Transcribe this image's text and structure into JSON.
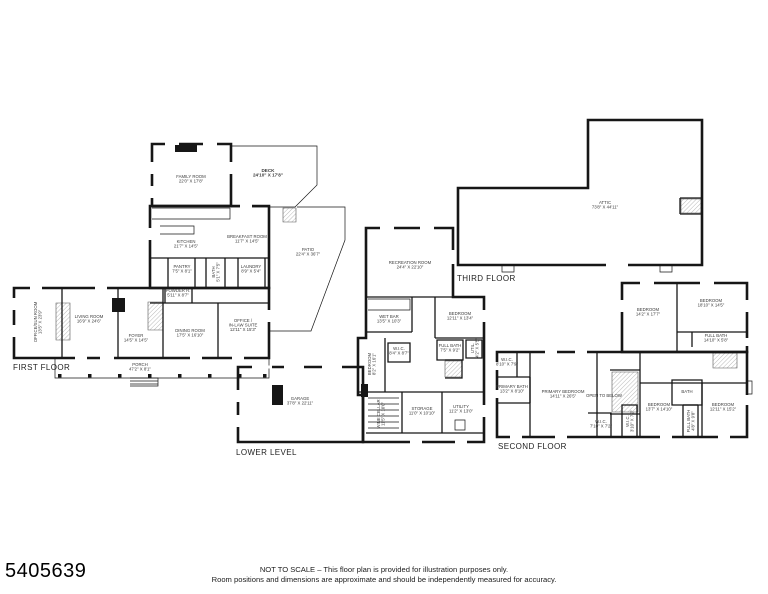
{
  "page": {
    "listing_id": "5405639",
    "disclaimer1": "NOT TO SCALE – This floor plan is provided for illustration purposes only.",
    "disclaimer2": "Room positions and dimensions are approximate and should be independently measured for accuracy."
  },
  "plan": {
    "ink": "#161616",
    "label_color": "#222222",
    "room_color": "#3a3a3a",
    "floors": [
      {
        "id": "first-floor",
        "label": "FIRST FLOOR",
        "label_x": 13,
        "label_y": 370,
        "walls": [
          "M152,144 H231 V206 H152 Z",
          "M150,206 H269 V288 H150 Z",
          "M14,288 H269 V358 H14 Z"
        ],
        "mid": [
          "M62,288 V358",
          "M118,288 V358",
          "M163,288 V358",
          "M150,258 H269",
          "M168,258 V288",
          "M195,258 V288",
          "M206,258 V288",
          "M225,258 V288",
          "M238,258 V288",
          "M265,258 V288",
          "M150,303 H269",
          "M165,288 V303",
          "M192,288 V303",
          "M218,303 V358"
        ],
        "thin": [
          "M231,146 H317 V185 L295,207 H231",
          "M297,207 H345 V240 L311,331 H269",
          "M55,358 V378 H269 V358",
          "M130,378 H158 V386 H130",
          "M130,381 H158",
          "M130,384 H158",
          "M152,208 H230 V219 H152",
          "M160,226 H194 V234 H160"
        ],
        "hatch": [
          "M56,303 h14 v37 h-14 Z",
          "M148,302 h15 v28 h-15 Z",
          "M283,208 h13 v14 h-13 Z"
        ],
        "solid": [
          "M175,145 h22 v7 h-22 Z",
          "M112,298 h13 v14 h-13 Z",
          "M58,374 h3.5 v3.5 h-3.5 Z M88,374 h3.5 v3.5 h-3.5 Z M118,374 h3.5 v3.5 h-3.5 Z M148,374 h3.5 v3.5 h-3.5 Z M178,374 h3.5 v3.5 h-3.5 Z M208,374 h3.5 v3.5 h-3.5 Z M238,374 h3.5 v3.5 h-3.5 Z M263,374 h3.5 v3.5 h-3.5 Z"
        ],
        "gaps": [
          "M75,358 h12",
          "M100,358 h14",
          "M190,358 h12",
          "M232,358 h12",
          "M14,298 v12",
          "M14,325 v12",
          "M30,288 h12",
          "M95,288 h12",
          "M165,144 h14",
          "M203,144 h14",
          "M152,162 v12",
          "M152,186 v12",
          "M231,162 v12",
          "M150,228 v12",
          "M240,206 h12",
          "M269,310 v12"
        ],
        "rooms": [
          {
            "name": "FAMILY ROOM",
            "dim": "22'0\" X 17'8\"",
            "x": 191,
            "y": 178
          },
          {
            "name": "DECK",
            "dim": "24'10\" X 17'8\"",
            "x": 268,
            "y": 172,
            "bold": true
          },
          {
            "name": "KITCHEN",
            "dim": "21'7\" X 14'5\"",
            "x": 186,
            "y": 243
          },
          {
            "name": "BREAKFAST ROOM",
            "dim": "11'7\" X 14'5\"",
            "x": 247,
            "y": 238
          },
          {
            "name": "PATIO",
            "dim": "22'4\" X 36'7\"",
            "x": 308,
            "y": 251
          },
          {
            "name": "PANTRY",
            "dim": "7'5\" X 8'1\"",
            "x": 182,
            "y": 268
          },
          {
            "name": "BATH",
            "dim": "5'1\" X 7'5\"",
            "x": 215,
            "y": 272,
            "vert": true
          },
          {
            "name": "LAUNDRY",
            "dim": "8'9\" X 5'4\"",
            "x": 251,
            "y": 268
          },
          {
            "name": "POWDER R.",
            "dim": "5'11\" X 8'7\"",
            "x": 178,
            "y": 292
          },
          {
            "name": "OFFICE/SUN ROOM",
            "dim": "13'5\" X 23'9\"",
            "x": 37,
            "y": 322,
            "vert": true
          },
          {
            "name": "LIVING ROOM",
            "dim": "16'9\" X 24'6\"",
            "x": 89,
            "y": 318
          },
          {
            "name": "FOYER",
            "dim": "14'5\" X 14'5\"",
            "x": 136,
            "y": 337
          },
          {
            "name": "DINING ROOM",
            "dim": "17'5\" X 16'10\"",
            "x": 190,
            "y": 332
          },
          {
            "name": "OFFICE /",
            "name2": "IN-LAW SUITE",
            "dim": "12'11\" X 15'3\"",
            "x": 243,
            "y": 322
          },
          {
            "name": "PORCH",
            "dim": "47'2\" X 8'1\"",
            "x": 140,
            "y": 366
          }
        ]
      },
      {
        "id": "lower-level",
        "label": "LOWER LEVEL",
        "label_x": 236,
        "label_y": 455,
        "walls": [
          "M238,367 H363 V442 H238 Z",
          "M366,228 H453 V297 H484 V442 H363 V395 H358 V338 H366 Z"
        ],
        "mid": [
          "M366,297 H453",
          "M412,297 V332",
          "M366,332 H412",
          "M435,297 V338",
          "M435,338 H484",
          "M358,392 H484",
          "M388,343 H410 V362 H388 Z",
          "M437,340 H463 V360 H437 Z",
          "M466,340 H482 V358 H466 Z",
          "M385,338 V392",
          "M402,392 V433",
          "M442,392 V433",
          "M366,433 H484",
          "M445,360 H462 V378 H445"
        ],
        "thin": [
          "M368,299 H410 V310 H368",
          "M368,398 H399",
          "M368,404 H399",
          "M368,410 H399",
          "M368,416 H399",
          "M368,422 H399",
          "M368,428 H399",
          "M455,420 h10 v10 h-10 Z"
        ],
        "hatch": [
          "M445,361 h17 v16 h-17 Z"
        ],
        "solid": [
          "M272,385 h11 v20 h-11 Z",
          "M361,384 h7 v13 h-7 Z"
        ],
        "gaps": [
          "M380,228 h14",
          "M420,228 h14",
          "M453,250 v14",
          "M484,310 v12",
          "M484,405 v12",
          "M252,367 h20",
          "M284,367 h20",
          "M322,367 h20",
          "M238,390 v12",
          "M238,415 v12",
          "M410,442 h12",
          "M455,442 h12"
        ],
        "rooms": [
          {
            "name": "RECREATION ROOM",
            "dim": "24'4\" X 22'10\"",
            "x": 410,
            "y": 264
          },
          {
            "name": "WET BAR",
            "dim": "13'5\" X 10'3\"",
            "x": 389,
            "y": 318
          },
          {
            "name": "BEDROOM",
            "dim": "12'11\" X 13'4\"",
            "x": 460,
            "y": 315
          },
          {
            "name": "W.I.C.",
            "dim": "8'4\" X 8'7\"",
            "x": 399,
            "y": 350
          },
          {
            "name": "FULL BATH",
            "dim": "7'5\" X 9'2\"",
            "x": 450,
            "y": 347
          },
          {
            "name": "UTIL.",
            "dim": "4'2\" X 5'5\"",
            "x": 474,
            "y": 348,
            "vert": true
          },
          {
            "name": "BEDROOM",
            "dim": "8'2\" X 16'1\"",
            "x": 371,
            "y": 364,
            "vert": true
          },
          {
            "name": "GARAGE",
            "dim": "37'8\" X 22'11\"",
            "x": 300,
            "y": 400
          },
          {
            "name": "WINE CELLAR",
            "dim": "11'5\" X 10'0\"",
            "x": 380,
            "y": 414,
            "vert": true
          },
          {
            "name": "STORAGE",
            "dim": "11'0\" X 10'10\"",
            "x": 422,
            "y": 410
          },
          {
            "name": "UTILITY",
            "dim": "11'2\" X 13'0\"",
            "x": 461,
            "y": 408
          }
        ]
      },
      {
        "id": "second-floor",
        "label": "SECOND FLOOR",
        "label_x": 498,
        "label_y": 449,
        "walls": [
          "M622,283 H747 V352 H622 Z",
          "M497,352 H747 V437 H497 Z"
        ],
        "mid": [
          "M677,283 V352",
          "M677,332 H747",
          "M692,332 V347",
          "M517,352 V377",
          "M497,377 H530",
          "M530,377 V403",
          "M497,403 H530",
          "M530,352 V437",
          "M597,352 V437",
          "M610,370 H640",
          "M610,414 H640",
          "M640,352 V437",
          "M640,383 H747",
          "M588,413 H611 V437",
          "M622,437 V405 H637 V437",
          "M672,380 H702 V405 H672 Z",
          "M683,405 V437",
          "M698,405 V437",
          "M683,405 H698",
          "M702,383 V437"
        ],
        "thin": [
          "M747,381 h5 v13 h-5"
        ],
        "hatch": [
          "M612,372 h26 v40 h-26 Z",
          "M713,353 h24 v15 h-24 Z"
        ],
        "solid": [],
        "gaps": [
          "M640,283 h14",
          "M700,283 h14",
          "M622,300 v12",
          "M747,300 v12",
          "M747,338 v8",
          "M510,437 h12",
          "M555,437 h12",
          "M660,437 h12",
          "M718,437 h12",
          "M497,362 v8",
          "M497,390 v8",
          "M545,352 h12",
          "M575,352 h12",
          "M747,395 v10"
        ],
        "rooms": [
          {
            "name": "BEDROOM",
            "dim": "14'2\" X 17'7\"",
            "x": 648,
            "y": 311
          },
          {
            "name": "BEDROOM",
            "dim": "18'10\" X 14'5\"",
            "x": 711,
            "y": 302
          },
          {
            "name": "FULL BATH",
            "dim": "14'10\" X 5'8\"",
            "x": 716,
            "y": 337
          },
          {
            "name": "W.I.C.",
            "dim": "8'10\" X 7'9\"",
            "x": 507,
            "y": 361
          },
          {
            "name": "PRIMARY BATH",
            "dim": "13'2\" X 8'10\"",
            "x": 512,
            "y": 388
          },
          {
            "name": "PRIMARY BEDROOM",
            "dim": "14'11\" X 26'5\"",
            "x": 563,
            "y": 393
          },
          {
            "name": "OPEN TO BELOW",
            "x": 604,
            "y": 397
          },
          {
            "name": "W.I.C.",
            "dim": "7'10\" X 7'2\"",
            "x": 601,
            "y": 423
          },
          {
            "name": "W.I.C.",
            "dim": "3'10\" X 7'2\"",
            "x": 629,
            "y": 421,
            "vert": true
          },
          {
            "name": "BEDROOM",
            "dim": "13'7\" X 14'10\"",
            "x": 659,
            "y": 406
          },
          {
            "name": "BATH",
            "x": 687,
            "y": 393
          },
          {
            "name": "FULL BATH",
            "dim": "4'8\" X 9'8\"",
            "x": 690,
            "y": 421,
            "vert": true
          },
          {
            "name": "BEDROOM",
            "dim": "12'11\" X 15'2\"",
            "x": 723,
            "y": 406
          }
        ]
      },
      {
        "id": "third-floor",
        "label": "THIRD FLOOR",
        "label_x": 457,
        "label_y": 281,
        "walls": [
          "M588,120 H702 V265 H458 V188 H588 Z"
        ],
        "mid": [
          "M680,198 H702",
          "M680,198 V214",
          "M680,214 H702"
        ],
        "thin": [
          "M502,265 v7 h12 v-7",
          "M660,265 v7 h12 v-7"
        ],
        "hatch": [
          "M681,199 h20 v14 h-20 Z"
        ],
        "solid": [],
        "gaps": [
          "M606,265 h22"
        ],
        "rooms": [
          {
            "name": "ATTIC",
            "dim": "73'8\" X 44'11\"",
            "x": 605,
            "y": 204
          }
        ]
      }
    ]
  }
}
